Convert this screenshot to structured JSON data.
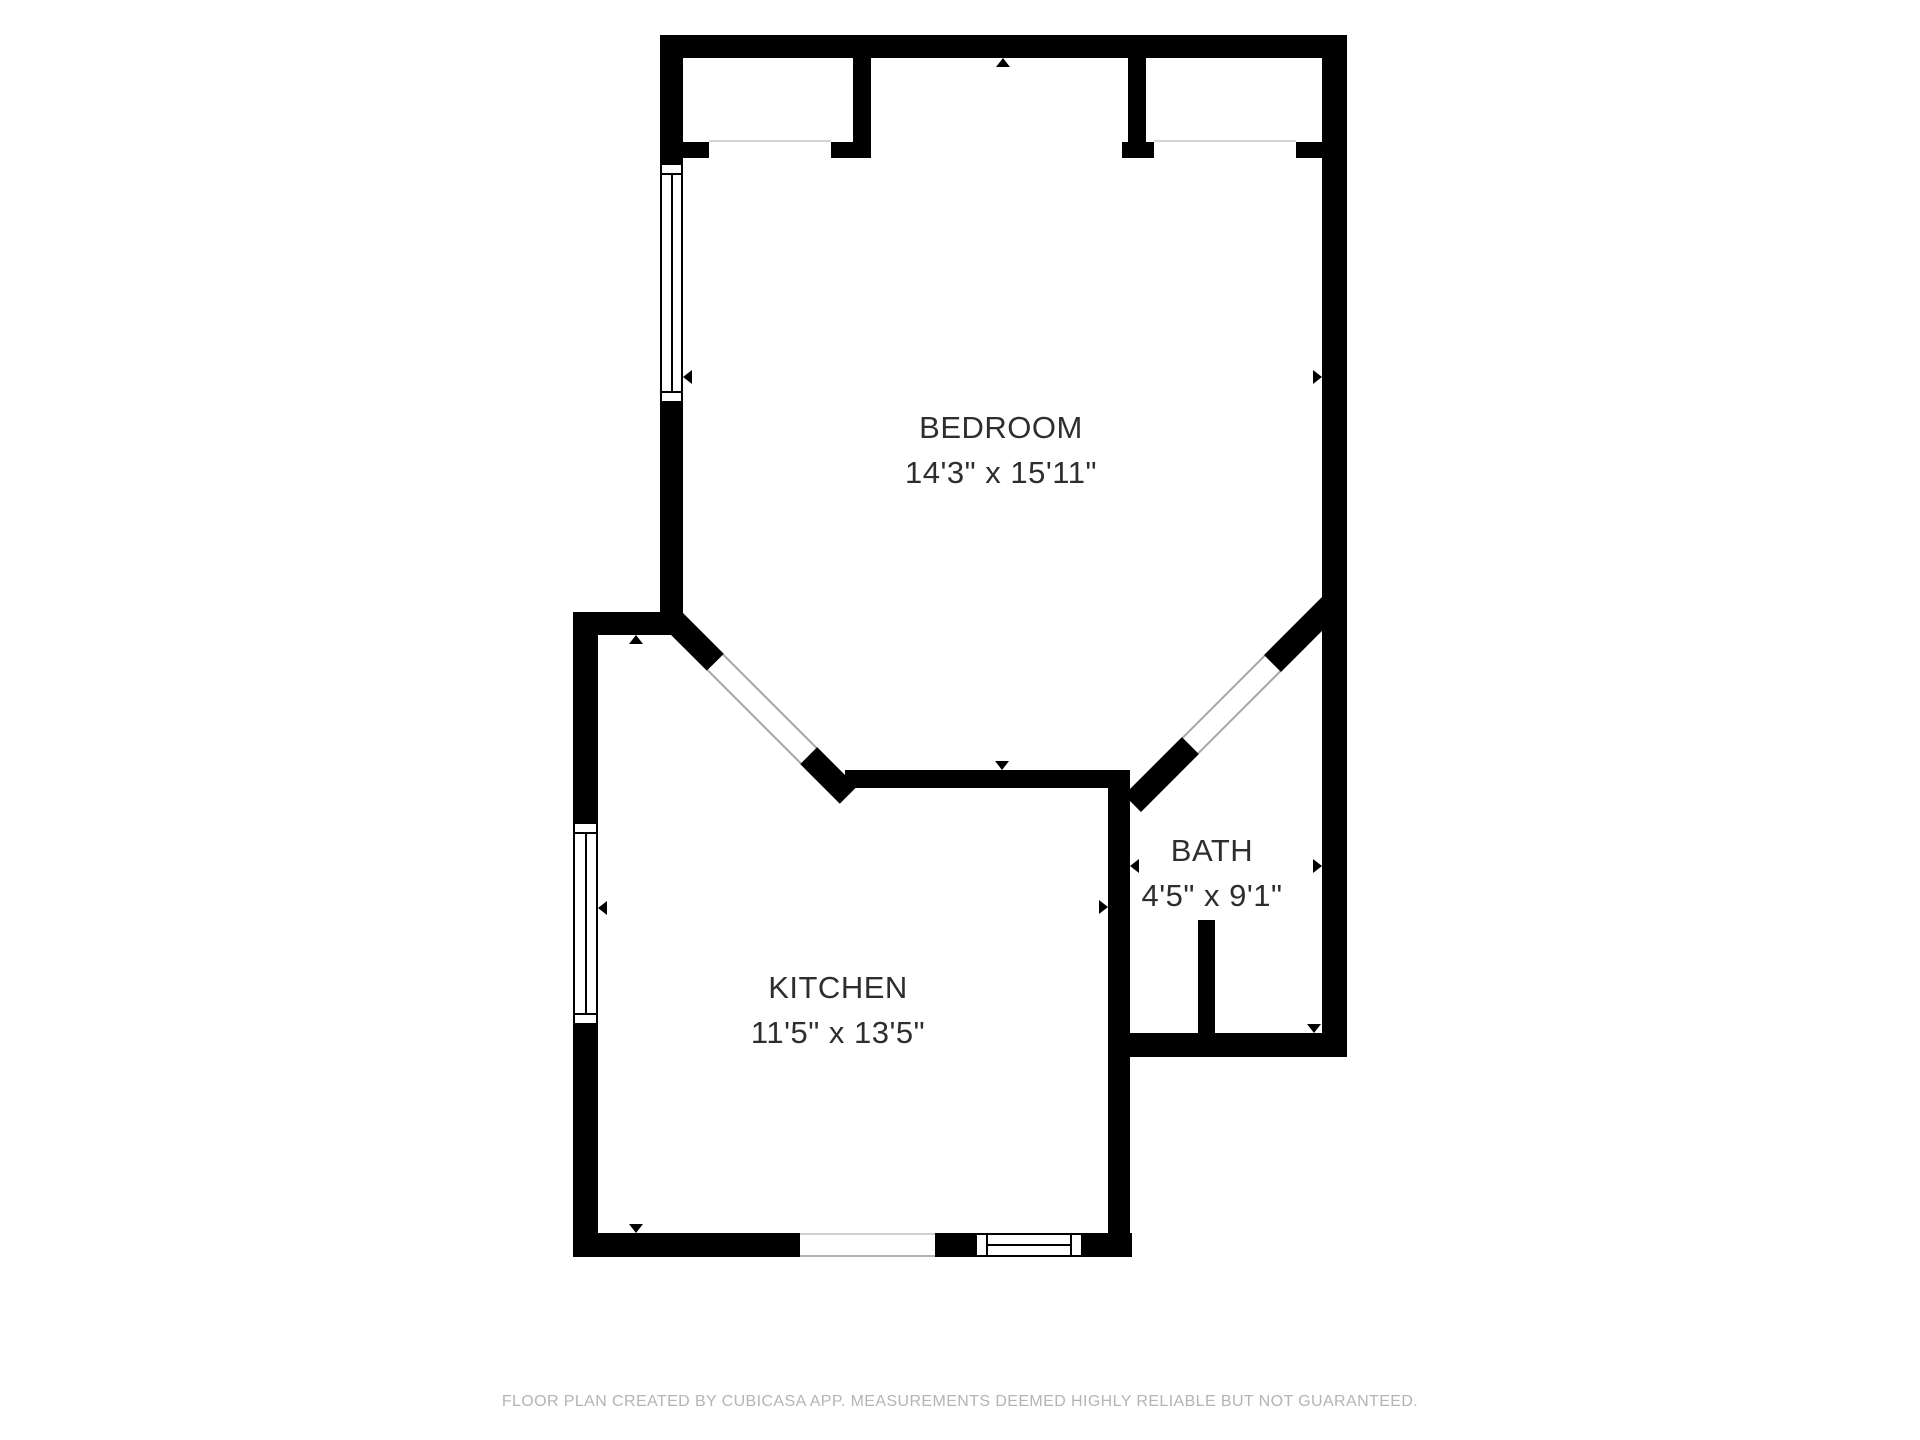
{
  "colors": {
    "background": "#ffffff",
    "wall": "#000000",
    "opening_line": "#b3b3b3",
    "label_text": "#2e2e2e",
    "footer_text": "#b4b4b4"
  },
  "icons": {
    "measurement_arrow": "small solid black triangle"
  },
  "rooms": [
    {
      "name": "BEDROOM",
      "dimensions": "14'3\" x 15'11\""
    },
    {
      "name": "KITCHEN",
      "dimensions": "11'5\" x 13'5\""
    },
    {
      "name": "BATH",
      "dimensions": "4'5\" x 9'1\""
    }
  ],
  "footer": {
    "text": "FLOOR PLAN CREATED BY CUBICASA APP. MEASUREMENTS DEEMED HIGHLY RELIABLE BUT NOT GUARANTEED."
  }
}
